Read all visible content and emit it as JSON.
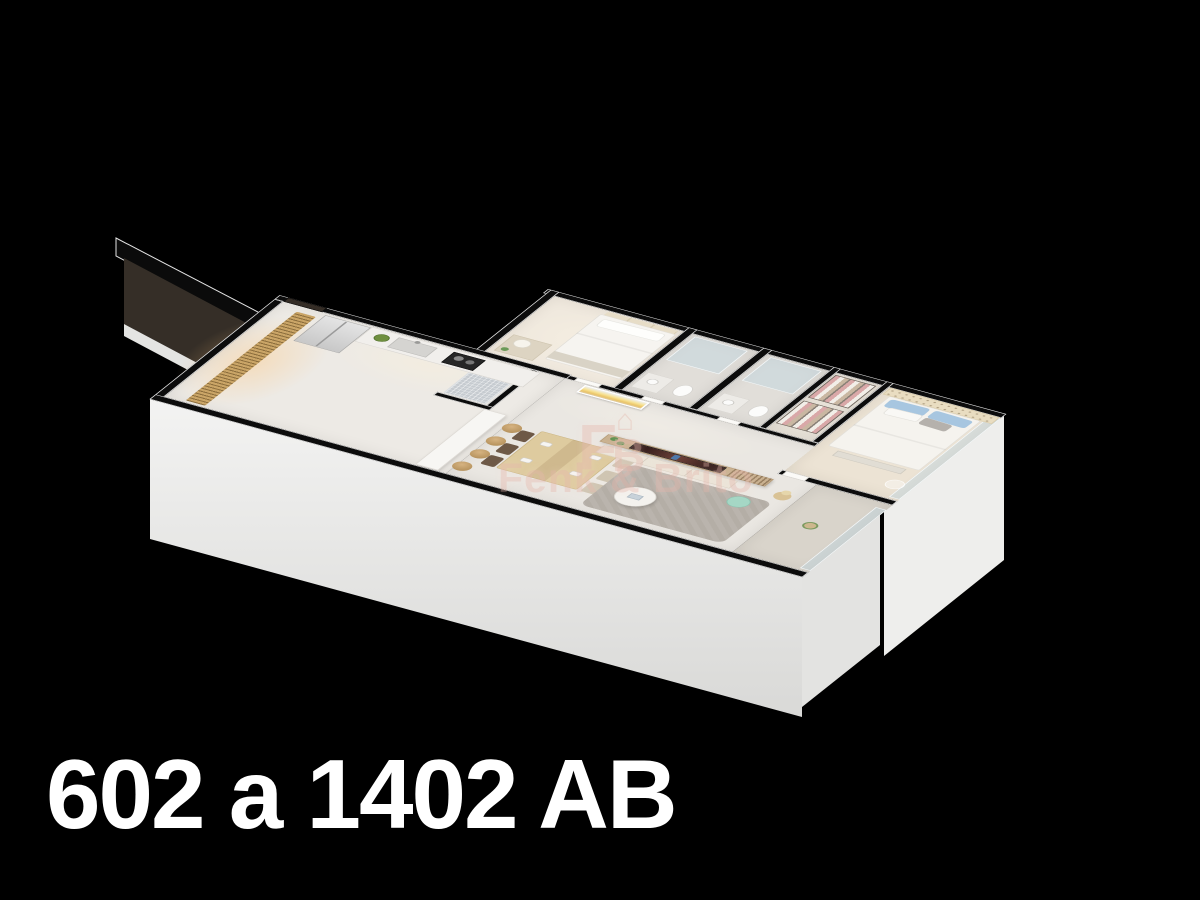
{
  "background_color": "#000000",
  "caption": {
    "text": "602 a 1402 AB",
    "color": "#ffffff"
  },
  "watermark": {
    "name": "Fenk & Brito",
    "monogram": {
      "letter_f": "F",
      "letter_b": "B",
      "house_glyph": "⌂"
    },
    "color": "#e2b4a6"
  },
  "floorplan": {
    "view": "isometric-3d-cutaway-apartment",
    "wall_cut_color": "#0c0c0c",
    "wall_trim_color": "#e9e9e9",
    "exterior_face_color": "#ececea",
    "rooms": [
      {
        "id": "entry",
        "furniture": [
          "entry-door",
          "wood-slat-partition"
        ]
      },
      {
        "id": "kitchen",
        "furniture": [
          "refrigerator",
          "counter-with-sink",
          "fruit-bowl",
          "cooktop",
          "service-glass-box",
          "bar-counter",
          "bar-stool x4"
        ]
      },
      {
        "id": "dining",
        "furniture": [
          "dining-table",
          "dining-chair x6",
          "sunset-artwork-triptych"
        ]
      },
      {
        "id": "living",
        "furniture": [
          "tv-panel-wood",
          "tv-screen",
          "media-console",
          "mint-pouf",
          "pampas-plant",
          "round-coffee-table",
          "gray-rug"
        ]
      },
      {
        "id": "balcony",
        "furniture": [
          "glass-railing",
          "potted-plant"
        ]
      },
      {
        "id": "bedroom-2",
        "furniture": [
          "single-bed",
          "headboard-cushions",
          "nightstand",
          "table-lamp",
          "plant"
        ]
      },
      {
        "id": "bathroom-1",
        "furniture": [
          "glass-shower",
          "vanity",
          "toilet"
        ]
      },
      {
        "id": "bathroom-2",
        "furniture": [
          "glass-shower",
          "vanity",
          "toilet"
        ]
      },
      {
        "id": "closet",
        "furniture": [
          "hanging-clothes-rack x2"
        ]
      },
      {
        "id": "master-bedroom",
        "furniture": [
          "double-bed",
          "tufted-headboard",
          "blue-pillows",
          "white-pillow",
          "gray-pillow",
          "foot-bench",
          "acrylic-chair",
          "glass-window"
        ]
      }
    ],
    "accent_colors": {
      "wood_slats": "#c9a567",
      "tv_panel": "#c9b190",
      "rug": "#b4aea6",
      "mint_pouf": "#a5d7c5",
      "pillow_blue": "#a7c6e0",
      "tufted_headboard": "#e9ddc1",
      "glass": "#bed4e0",
      "floor_light": "#eae7e2"
    }
  }
}
